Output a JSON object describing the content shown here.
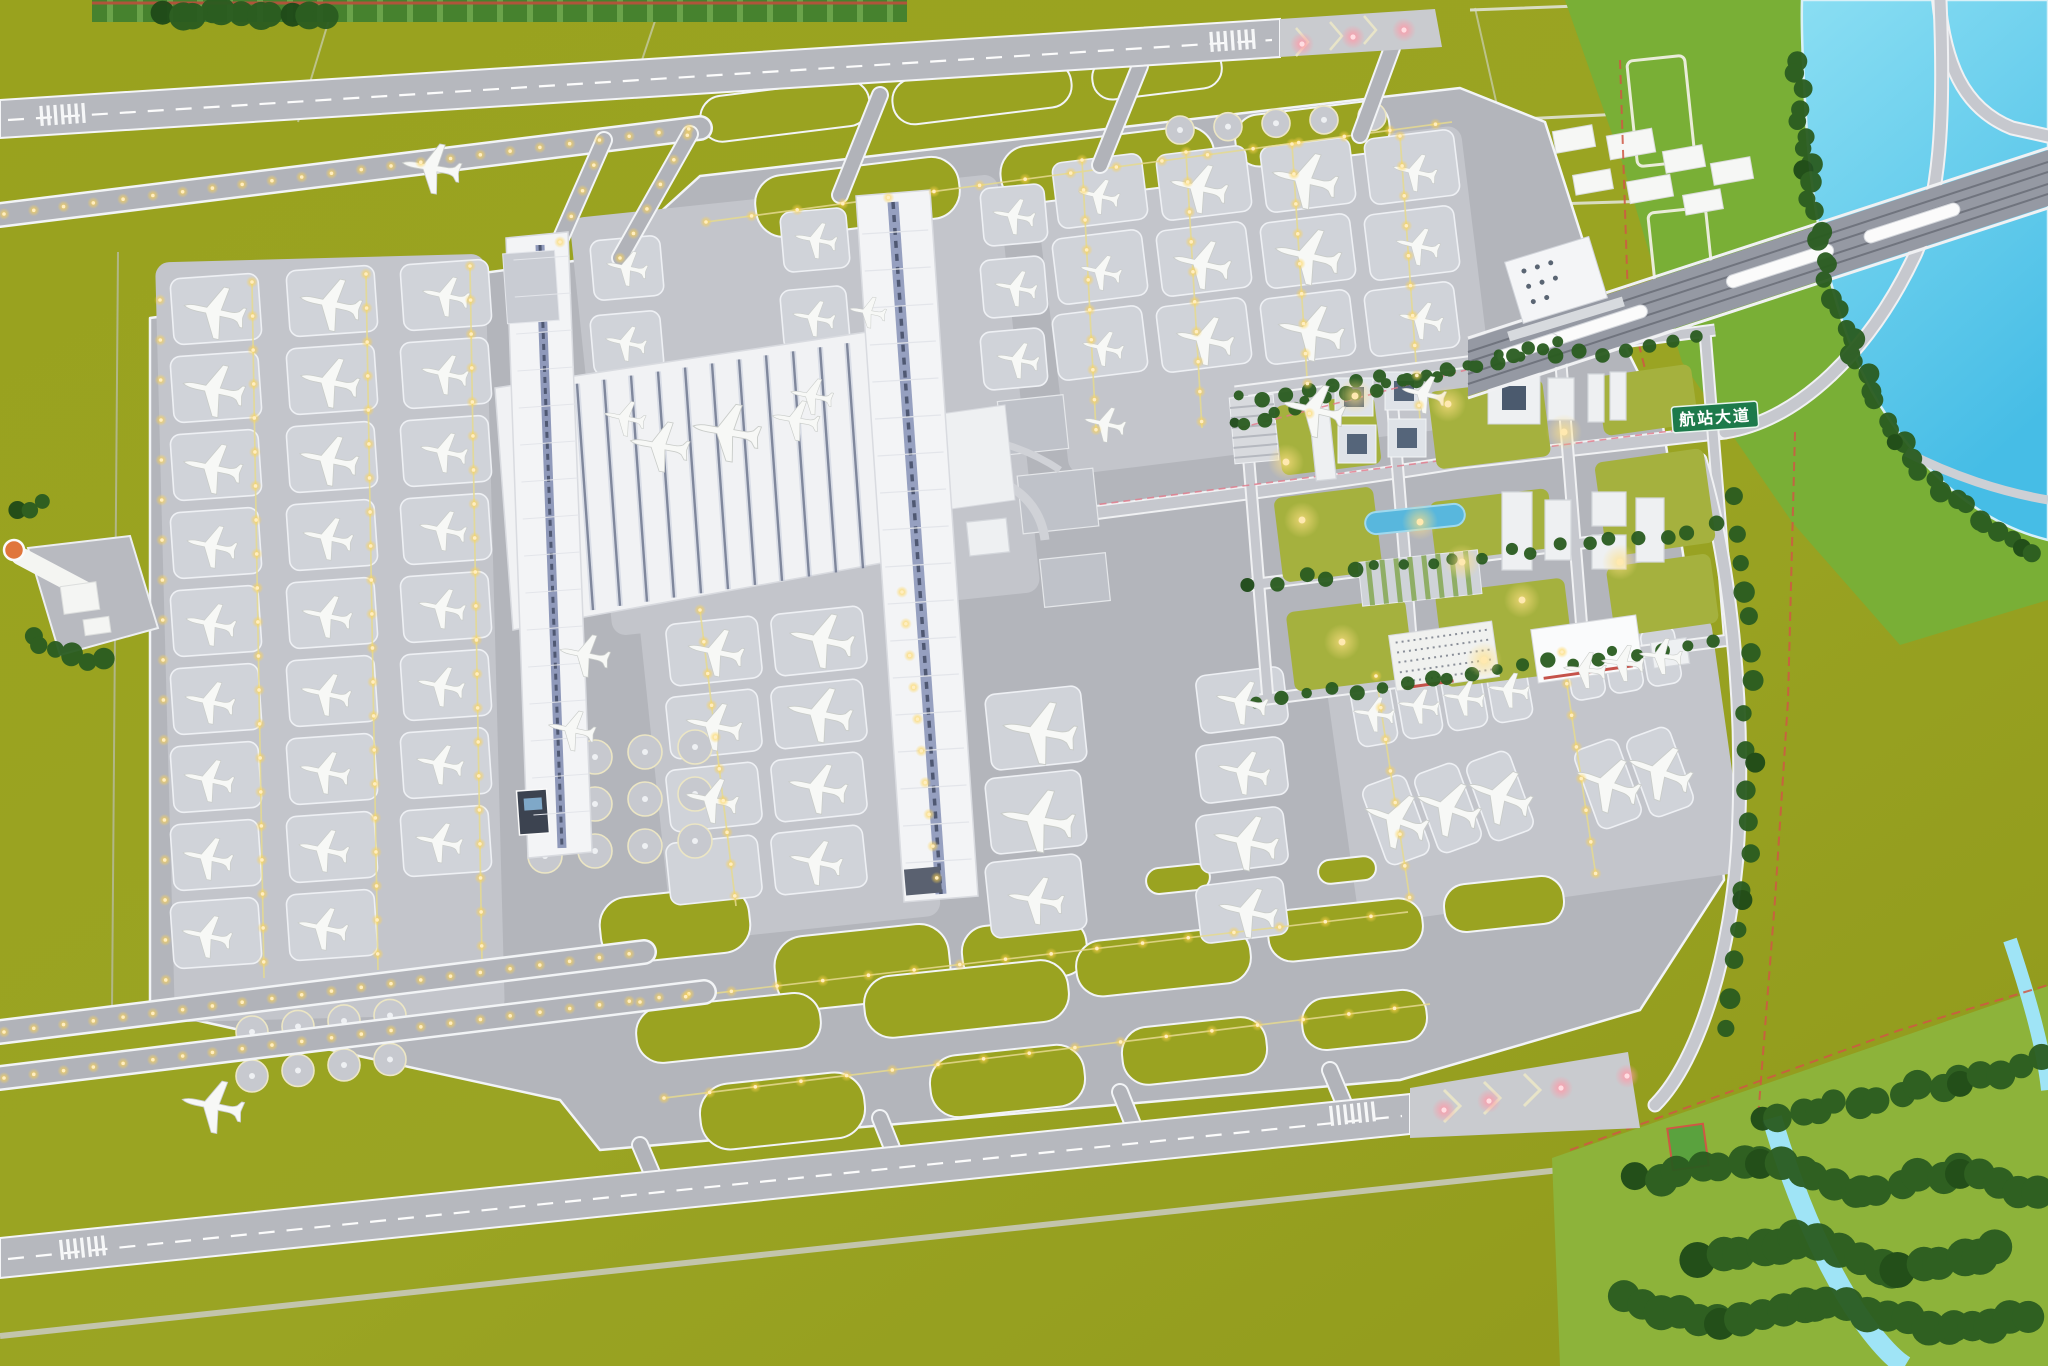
{
  "meta": {
    "type": "photograph",
    "subject": "Aerial view of an airport scale model: H-shaped white terminal with two long piers, two parallel runways with taxiway loops, rows of parked model aircraft, landside business district with pond and office blocks, rail corridor with trains crossing a river, green farmland base"
  },
  "sign": {
    "text": "航站大道",
    "bg": "#1d7a4b",
    "fg": "#ffffff"
  },
  "palette": {
    "grass_olive": "#9aa321",
    "grass_bright": "#79af36",
    "tree_dark": "#1e4a18",
    "water": "#5cc9ea",
    "pavement": "#b3b5bb",
    "apron": "#c3c5cb",
    "terminal_white": "#f1f2f4",
    "skylight_blue": "#5d6680",
    "taxi_light_yellow": "#ffd34d",
    "runway_end_pink": "#ff9aa8",
    "boundary_red": "#cf5844"
  },
  "counts": {
    "aircraft": 84,
    "runways": 2,
    "terminal_piers": 2,
    "trains": 4
  },
  "planes": [
    [
      215,
      312,
      -78,
      1.05
    ],
    [
      214,
      390,
      -78,
      1.05
    ],
    [
      213,
      468,
      -78,
      1.0
    ],
    [
      212,
      546,
      -78,
      0.85
    ],
    [
      211,
      624,
      -78,
      0.85
    ],
    [
      210,
      702,
      -78,
      0.85
    ],
    [
      209,
      780,
      -78,
      0.85
    ],
    [
      208,
      858,
      -78,
      0.85
    ],
    [
      207,
      936,
      -78,
      0.85
    ],
    [
      331,
      304,
      -78,
      1.05
    ],
    [
      330,
      382,
      -78,
      1.0
    ],
    [
      329,
      460,
      -78,
      1.0
    ],
    [
      328,
      538,
      -78,
      0.85
    ],
    [
      327,
      616,
      -78,
      0.85
    ],
    [
      326,
      694,
      -78,
      0.85
    ],
    [
      325,
      772,
      -78,
      0.85
    ],
    [
      324,
      850,
      -78,
      0.85
    ],
    [
      323,
      928,
      -78,
      0.85
    ],
    [
      446,
      296,
      -78,
      0.8
    ],
    [
      445,
      374,
      -78,
      0.8
    ],
    [
      444,
      452,
      -78,
      0.8
    ],
    [
      443,
      530,
      -78,
      0.8
    ],
    [
      442,
      608,
      -78,
      0.8
    ],
    [
      441,
      686,
      -78,
      0.8
    ],
    [
      440,
      764,
      -78,
      0.8
    ],
    [
      439,
      842,
      -78,
      0.8
    ],
    [
      627,
      268,
      -78,
      0.7
    ],
    [
      626,
      343,
      -78,
      0.7
    ],
    [
      625,
      418,
      -78,
      0.7
    ],
    [
      816,
      240,
      -79,
      0.72
    ],
    [
      814,
      318,
      -79,
      0.72
    ],
    [
      812,
      396,
      -79,
      0.72
    ],
    [
      1014,
      216,
      -79,
      0.72
    ],
    [
      1016,
      288,
      -79,
      0.72
    ],
    [
      1018,
      360,
      -79,
      0.72
    ],
    [
      1099,
      196,
      -77,
      0.7
    ],
    [
      1101,
      272,
      -77,
      0.7
    ],
    [
      1103,
      348,
      -77,
      0.7
    ],
    [
      1105,
      424,
      -77,
      0.7
    ],
    [
      1199,
      188,
      -77,
      0.98
    ],
    [
      1202,
      264,
      -77,
      0.98
    ],
    [
      1205,
      340,
      -77,
      0.98
    ],
    [
      1305,
      180,
      -77,
      1.12
    ],
    [
      1308,
      256,
      -77,
      1.12
    ],
    [
      1311,
      332,
      -77,
      1.12
    ],
    [
      1314,
      410,
      -77,
      1.05
    ],
    [
      1415,
      172,
      -77,
      0.75
    ],
    [
      1418,
      246,
      -77,
      0.75
    ],
    [
      1421,
      320,
      -77,
      0.75
    ],
    [
      1424,
      394,
      -77,
      0.75
    ],
    [
      660,
      446,
      -80,
      1.0
    ],
    [
      727,
      432,
      -80,
      1.15
    ],
    [
      796,
      420,
      -80,
      0.8
    ],
    [
      868,
      312,
      -80,
      0.62
    ],
    [
      716,
      652,
      -78,
      0.95
    ],
    [
      714,
      726,
      -78,
      0.95
    ],
    [
      712,
      800,
      -78,
      0.9
    ],
    [
      822,
      640,
      -78,
      1.1
    ],
    [
      820,
      714,
      -78,
      1.1
    ],
    [
      818,
      788,
      -78,
      1.0
    ],
    [
      816,
      862,
      -78,
      0.9
    ],
    [
      585,
      655,
      -78,
      0.85
    ],
    [
      572,
      730,
      -78,
      0.8
    ],
    [
      1040,
      732,
      -80,
      1.25
    ],
    [
      1038,
      820,
      -80,
      1.25
    ],
    [
      1036,
      900,
      -80,
      0.95
    ],
    [
      1242,
      702,
      -77,
      0.88
    ],
    [
      1244,
      772,
      -77,
      0.88
    ],
    [
      1246,
      842,
      -77,
      1.1
    ],
    [
      1248,
      912,
      -77,
      1.0
    ],
    [
      1374,
      714,
      -82,
      0.7
    ],
    [
      1419,
      706,
      -82,
      0.7
    ],
    [
      1464,
      698,
      -82,
      0.7
    ],
    [
      1509,
      690,
      -82,
      0.7
    ],
    [
      1585,
      670,
      -84,
      0.72
    ],
    [
      1623,
      663,
      -84,
      0.72
    ],
    [
      1661,
      656,
      -84,
      0.72
    ],
    [
      1396,
      820,
      -70,
      1.1
    ],
    [
      1448,
      808,
      -70,
      1.1
    ],
    [
      1500,
      796,
      -70,
      1.1
    ],
    [
      1608,
      784,
      -70,
      1.1
    ],
    [
      1660,
      772,
      -70,
      1.1
    ],
    [
      432,
      168,
      -80,
      1.0
    ],
    [
      213,
      1106,
      -78,
      1.05
    ]
  ],
  "trains": [
    [
      1590,
      328,
      -18,
      120
    ],
    [
      1780,
      266,
      -18,
      112
    ],
    [
      1912,
      223,
      -18,
      100
    ],
    [
      1528,
      348,
      -18,
      64
    ]
  ],
  "light_paths": [
    {
      "pts": [
        [
          4,
          214
        ],
        [
          696,
          128
        ]
      ],
      "step": 30
    },
    {
      "pts": [
        [
          4,
          1032
        ],
        [
          644,
          952
        ]
      ],
      "step": 30
    },
    {
      "pts": [
        [
          4,
          1078
        ],
        [
          704,
          992
        ]
      ],
      "step": 30
    },
    {
      "pts": [
        [
          252,
          282
        ],
        [
          264,
          978
        ]
      ],
      "step": 34
    },
    {
      "pts": [
        [
          366,
          274
        ],
        [
          378,
          970
        ]
      ],
      "step": 34
    },
    {
      "pts": [
        [
          470,
          266
        ],
        [
          482,
          962
        ]
      ],
      "step": 34
    },
    {
      "pts": [
        [
          1082,
          160
        ],
        [
          1096,
          430
        ]
      ],
      "step": 30
    },
    {
      "pts": [
        [
          1186,
          152
        ],
        [
          1202,
          428
        ]
      ],
      "step": 30
    },
    {
      "pts": [
        [
          1292,
          144
        ],
        [
          1310,
          424
        ]
      ],
      "step": 30
    },
    {
      "pts": [
        [
          1400,
          136
        ],
        [
          1420,
          420
        ]
      ],
      "step": 30
    },
    {
      "pts": [
        [
          700,
          610
        ],
        [
          736,
          906
        ]
      ],
      "step": 32
    },
    {
      "pts": [
        [
          902,
          592
        ],
        [
          938,
          888
        ]
      ],
      "step": 32
    },
    {
      "pts": [
        [
          1376,
          676
        ],
        [
          1410,
          900
        ]
      ],
      "step": 32
    },
    {
      "pts": [
        [
          1562,
          652
        ],
        [
          1596,
          876
        ]
      ],
      "step": 32
    },
    {
      "pts": [
        [
          640,
          1002
        ],
        [
          1408,
          912
        ]
      ],
      "step": 46
    },
    {
      "pts": [
        [
          664,
          1098
        ],
        [
          1430,
          1004
        ]
      ],
      "step": 46
    },
    {
      "pts": [
        [
          706,
          222
        ],
        [
          1452,
          122
        ]
      ],
      "step": 46
    },
    {
      "pts": [
        [
          160,
          300
        ],
        [
          166,
          1006
        ]
      ],
      "step": 40
    },
    {
      "pts": [
        [
          620,
          258
        ],
        [
          688,
          134
        ]
      ],
      "step": 28
    },
    {
      "pts": [
        [
          560,
          242
        ],
        [
          604,
          142
        ]
      ],
      "step": 28
    }
  ],
  "pink_lights": [
    [
      1302,
      44
    ],
    [
      1353,
      37
    ],
    [
      1404,
      30
    ],
    [
      1444,
      1110
    ],
    [
      1489,
      1101
    ],
    [
      1561,
      1088
    ],
    [
      1627,
      1076
    ]
  ],
  "glow_spots": [
    [
      1355,
      396
    ],
    [
      1302,
      520
    ],
    [
      1420,
      522
    ],
    [
      1462,
      562
    ],
    [
      1522,
      600
    ],
    [
      1342,
      642
    ],
    [
      1564,
      432
    ],
    [
      1620,
      562
    ],
    [
      1484,
      660
    ],
    [
      1286,
      462
    ],
    [
      1448,
      404
    ]
  ],
  "stand_grids": [
    {
      "x": 172,
      "y": 276,
      "cols": 1,
      "rows": 9,
      "dy": 78,
      "w": 88,
      "h": 66,
      "rot": -4
    },
    {
      "x": 288,
      "y": 268,
      "cols": 1,
      "rows": 9,
      "dy": 78,
      "w": 88,
      "h": 66,
      "rot": -4
    },
    {
      "x": 402,
      "y": 262,
      "cols": 1,
      "rows": 8,
      "dy": 78,
      "w": 88,
      "h": 66,
      "rot": -4
    },
    {
      "x": 592,
      "y": 238,
      "cols": 1,
      "rows": 3,
      "dy": 75,
      "w": 70,
      "h": 60,
      "rot": -5
    },
    {
      "x": 782,
      "y": 210,
      "cols": 1,
      "rows": 3,
      "dy": 78,
      "w": 66,
      "h": 60,
      "rot": -5
    },
    {
      "x": 982,
      "y": 186,
      "cols": 1,
      "rows": 3,
      "dy": 72,
      "w": 64,
      "h": 58,
      "rot": -5
    },
    {
      "x": 1055,
      "y": 158,
      "cols": 4,
      "rows": 3,
      "dx": 104,
      "dy": 76,
      "sy": -8,
      "w": 90,
      "h": 66,
      "rot": -7
    },
    {
      "x": 668,
      "y": 620,
      "cols": 2,
      "rows": 4,
      "dx": 105,
      "dy": 73,
      "sy": -10,
      "w": 92,
      "h": 62,
      "rot": -6
    },
    {
      "x": 1198,
      "y": 671,
      "cols": 1,
      "rows": 4,
      "dy": 70,
      "w": 88,
      "h": 58,
      "rot": -7
    },
    {
      "x": 988,
      "y": 690,
      "cols": 1,
      "rows": 3,
      "dy": 84,
      "w": 96,
      "h": 76,
      "rot": -6
    },
    {
      "x": 1354,
      "y": 683,
      "cols": 4,
      "rows": 1,
      "dx": 45,
      "sy": -8,
      "w": 40,
      "h": 62,
      "rot": -10
    },
    {
      "x": 1568,
      "y": 641,
      "cols": 3,
      "rows": 1,
      "dx": 38,
      "sy": -7,
      "w": 34,
      "h": 58,
      "rot": -10
    },
    {
      "x": 1373,
      "y": 778,
      "cols": 3,
      "rows": 1,
      "dx": 52,
      "sy": -12,
      "w": 46,
      "h": 84,
      "rot": -20
    },
    {
      "x": 1585,
      "y": 742,
      "cols": 2,
      "rows": 1,
      "dx": 52,
      "sy": -12,
      "w": 46,
      "h": 84,
      "rot": -20
    }
  ],
  "deicing_pads": [
    {
      "x": 252,
      "y": 1032,
      "cols": 4,
      "rows": 2,
      "dx": 46,
      "dy": 44,
      "r": 16,
      "slope": -0.12
    },
    {
      "x": 1180,
      "y": 130,
      "cols": 5,
      "rows": 1,
      "dx": 48,
      "dy": 0,
      "r": 14,
      "slope": -0.07
    },
    {
      "x": 545,
      "y": 762,
      "cols": 4,
      "rows": 3,
      "dx": 50,
      "dy": 47,
      "r": 17,
      "slope": -0.1
    }
  ],
  "tree_lines": [
    {
      "pts": [
        [
          1796,
          60
        ],
        [
          1806,
          170
        ],
        [
          1824,
          268
        ],
        [
          1856,
          364
        ],
        [
          1900,
          446
        ],
        [
          1956,
          502
        ]
      ],
      "step": 15,
      "r": 8
    },
    {
      "pts": [
        [
          1962,
          508
        ],
        [
          2022,
          544
        ],
        [
          2048,
          556
        ]
      ],
      "step": 15,
      "r": 8
    },
    {
      "pts": [
        [
          1240,
          398
        ],
        [
          1710,
          336
        ]
      ],
      "step": 24,
      "r": 5
    },
    {
      "pts": [
        [
          1250,
          585
        ],
        [
          1725,
          525
        ]
      ],
      "step": 26,
      "r": 5
    },
    {
      "pts": [
        [
          1260,
          700
        ],
        [
          1730,
          640
        ]
      ],
      "step": 24,
      "r": 5
    },
    {
      "pts": [
        [
          1640,
          1180
        ],
        [
          1760,
          1160
        ],
        [
          1860,
          1190
        ],
        [
          1960,
          1170
        ],
        [
          2048,
          1200
        ]
      ],
      "step": 20,
      "r": 14
    },
    {
      "pts": [
        [
          1700,
          1260
        ],
        [
          1800,
          1240
        ],
        [
          1900,
          1270
        ],
        [
          2000,
          1250
        ]
      ],
      "step": 20,
      "r": 16
    },
    {
      "pts": [
        [
          1760,
          1120
        ],
        [
          1860,
          1100
        ],
        [
          1960,
          1080
        ],
        [
          2040,
          1060
        ]
      ],
      "step": 20,
      "r": 12
    },
    {
      "pts": [
        [
          1620,
          1300
        ],
        [
          1720,
          1320
        ],
        [
          1830,
          1300
        ],
        [
          1950,
          1330
        ],
        [
          2040,
          1310
        ]
      ],
      "step": 20,
      "r": 15
    },
    {
      "pts": [
        [
          160,
          14
        ],
        [
          220,
          10
        ],
        [
          290,
          16
        ],
        [
          340,
          12
        ]
      ],
      "step": 18,
      "r": 12
    },
    {
      "pts": [
        [
          30,
          640
        ],
        [
          70,
          655
        ],
        [
          110,
          662
        ]
      ],
      "step": 14,
      "r": 8
    },
    {
      "pts": [
        [
          20,
          510
        ],
        [
          55,
          500
        ]
      ],
      "step": 14,
      "r": 7
    },
    {
      "pts": [
        [
          1730,
          500
        ],
        [
          1745,
          620
        ],
        [
          1750,
          760
        ],
        [
          1745,
          900
        ],
        [
          1720,
          1040
        ]
      ],
      "step": 32,
      "r": 8
    },
    {
      "pts": [
        [
          1232,
          424
        ],
        [
          1500,
          357
        ],
        [
          1565,
          342
        ]
      ],
      "step": 16,
      "r": 5
    }
  ],
  "thresholds": [
    {
      "x": 40,
      "y": 116,
      "rot": -4
    },
    {
      "x": 1210,
      "y": 42,
      "rot": -4
    },
    {
      "x": 60,
      "y": 1250,
      "rot": -6
    },
    {
      "x": 1330,
      "y": 1116,
      "rot": -6
    }
  ]
}
